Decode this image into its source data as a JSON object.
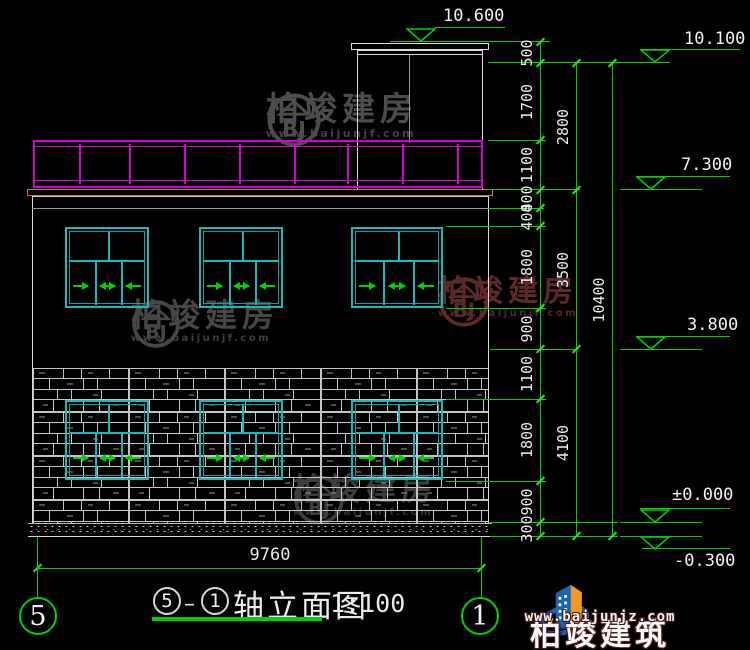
{
  "colors": {
    "green": "#00d200",
    "cyan": "#1ab8b8",
    "magenta": "#d400d4",
    "slab": "#bf7a35",
    "white_line": "#d9d9d9"
  },
  "watermark": {
    "text": "柏竣建房",
    "url": "www.baijunjf.com",
    "logo_letters": "BJ",
    "instances": [
      {
        "x": 266,
        "y": 92,
        "logo": 56,
        "font": 33,
        "sub": 11,
        "color": "#4d4d4d",
        "sub_color": "#4a4040"
      },
      {
        "x": 131,
        "y": 299,
        "logo": 50,
        "font": 32,
        "sub": 10,
        "color": "#474747",
        "sub_color": "#453c3c"
      },
      {
        "x": 438,
        "y": 276,
        "logo": 52,
        "font": 30,
        "sub": 10,
        "color": "#5e2929",
        "sub_color": "#552626"
      },
      {
        "x": 293,
        "y": 474,
        "logo": 52,
        "font": 31,
        "sub": 10,
        "color": "#3d3d3d",
        "sub_color": "#3a3030"
      }
    ]
  },
  "building": {
    "railing": {
      "x": 33,
      "y": 140,
      "w": 450,
      "h": 48,
      "posts": [
        44,
        94,
        149,
        204,
        259,
        312,
        367,
        422
      ]
    },
    "bulkhead": {
      "cap1": [
        351,
        43,
        138,
        7
      ],
      "cap2": [
        357,
        50,
        126,
        5
      ],
      "wall_l": 357,
      "wall_r": 482,
      "wall_top": 55,
      "wall_bot": 190,
      "inner_x": 409,
      "inner_bot": 143
    },
    "slab": [
      27,
      189,
      466,
      7
    ],
    "wall": [
      32,
      196,
      457,
      327
    ],
    "beam_y": 208,
    "stone": [
      33,
      368,
      455,
      155
    ],
    "speckle": [
      28,
      523,
      464,
      14
    ]
  },
  "windows": {
    "cols": [
      [
        65,
        84
      ],
      [
        199,
        84
      ],
      [
        351,
        92
      ]
    ],
    "floors": [
      {
        "y": 227,
        "h": 81
      },
      {
        "y": 400,
        "h": 80
      }
    ],
    "divider_ratio": 0.38,
    "arrows": [
      "r",
      "lr",
      "l"
    ]
  },
  "dims": {
    "chains": [
      {
        "x": 540,
        "boundaries": [
          42,
          63,
          140,
          190,
          208,
          226,
          308,
          349,
          399,
          481,
          522,
          536
        ],
        "labels": [
          "500",
          "1700",
          "1100",
          "400",
          "400",
          "1800",
          "900",
          "1100",
          "1800",
          "900",
          "300"
        ]
      },
      {
        "x": 576,
        "boundaries": [
          63,
          190,
          349,
          536
        ],
        "labels": [
          "2800",
          "3500",
          "4100"
        ]
      },
      {
        "x": 612,
        "boundaries": [
          63,
          536
        ],
        "labels": [
          "10400"
        ]
      }
    ],
    "ext_lines": [
      [
        488,
        62,
        152
      ],
      [
        488,
        140,
        58
      ],
      [
        488,
        189,
        92
      ],
      [
        488,
        208,
        56
      ],
      [
        446,
        226,
        100
      ],
      [
        446,
        308,
        100
      ],
      [
        490,
        349,
        88
      ],
      [
        446,
        399,
        100
      ],
      [
        446,
        481,
        100
      ],
      [
        490,
        522,
        128
      ],
      [
        490,
        536,
        128
      ],
      [
        390,
        41,
        160
      ]
    ],
    "bottom": {
      "label": "9760",
      "line": [
        37,
        568,
        444
      ],
      "vlines": [
        [
          37,
          537,
          61
        ],
        [
          481,
          537,
          61
        ]
      ],
      "text_x": 225,
      "text_y": 545
    }
  },
  "elevation_markers": [
    {
      "label": "10.600",
      "text": [
        443,
        6
      ],
      "leader": [
        435,
        27,
        70
      ],
      "tri": [
        406,
        28
      ],
      "level": null,
      "below": false
    },
    {
      "label": "10.100",
      "text": [
        684,
        29
      ],
      "leader": [
        640,
        49,
        100
      ],
      "tri": [
        640,
        49
      ],
      "level": [
        628,
        62,
        42
      ],
      "below": false
    },
    {
      "label": "7.300",
      "text": [
        681,
        155
      ],
      "leader": [
        636,
        176,
        94
      ],
      "tri": [
        636,
        176
      ],
      "level": [
        620,
        189,
        82
      ],
      "below": false
    },
    {
      "label": "3.800",
      "text": [
        687,
        315
      ],
      "leader": [
        636,
        336,
        94
      ],
      "tri": [
        636,
        336
      ],
      "level": [
        620,
        349,
        82
      ],
      "below": false
    },
    {
      "label": "±0.000",
      "text": [
        672,
        485
      ],
      "leader": [
        640,
        508,
        90
      ],
      "tri": [
        640,
        509
      ],
      "level": [
        620,
        522,
        82
      ],
      "below": false
    },
    {
      "label": "-0.300",
      "text": [
        674,
        551
      ],
      "leader": [
        642,
        548,
        88
      ],
      "tri": [
        640,
        536
      ],
      "level": [
        620,
        536,
        82
      ],
      "below": true
    }
  ],
  "axis_bubbles": {
    "left": "5",
    "right": "1"
  },
  "title_block": {
    "circle_start": "5",
    "dash": "–",
    "circle_end": "1",
    "text": "轴立面图",
    "scale": "1:100"
  },
  "brand": {
    "name": "柏竣建筑",
    "url": "www.baijunjz.com"
  }
}
